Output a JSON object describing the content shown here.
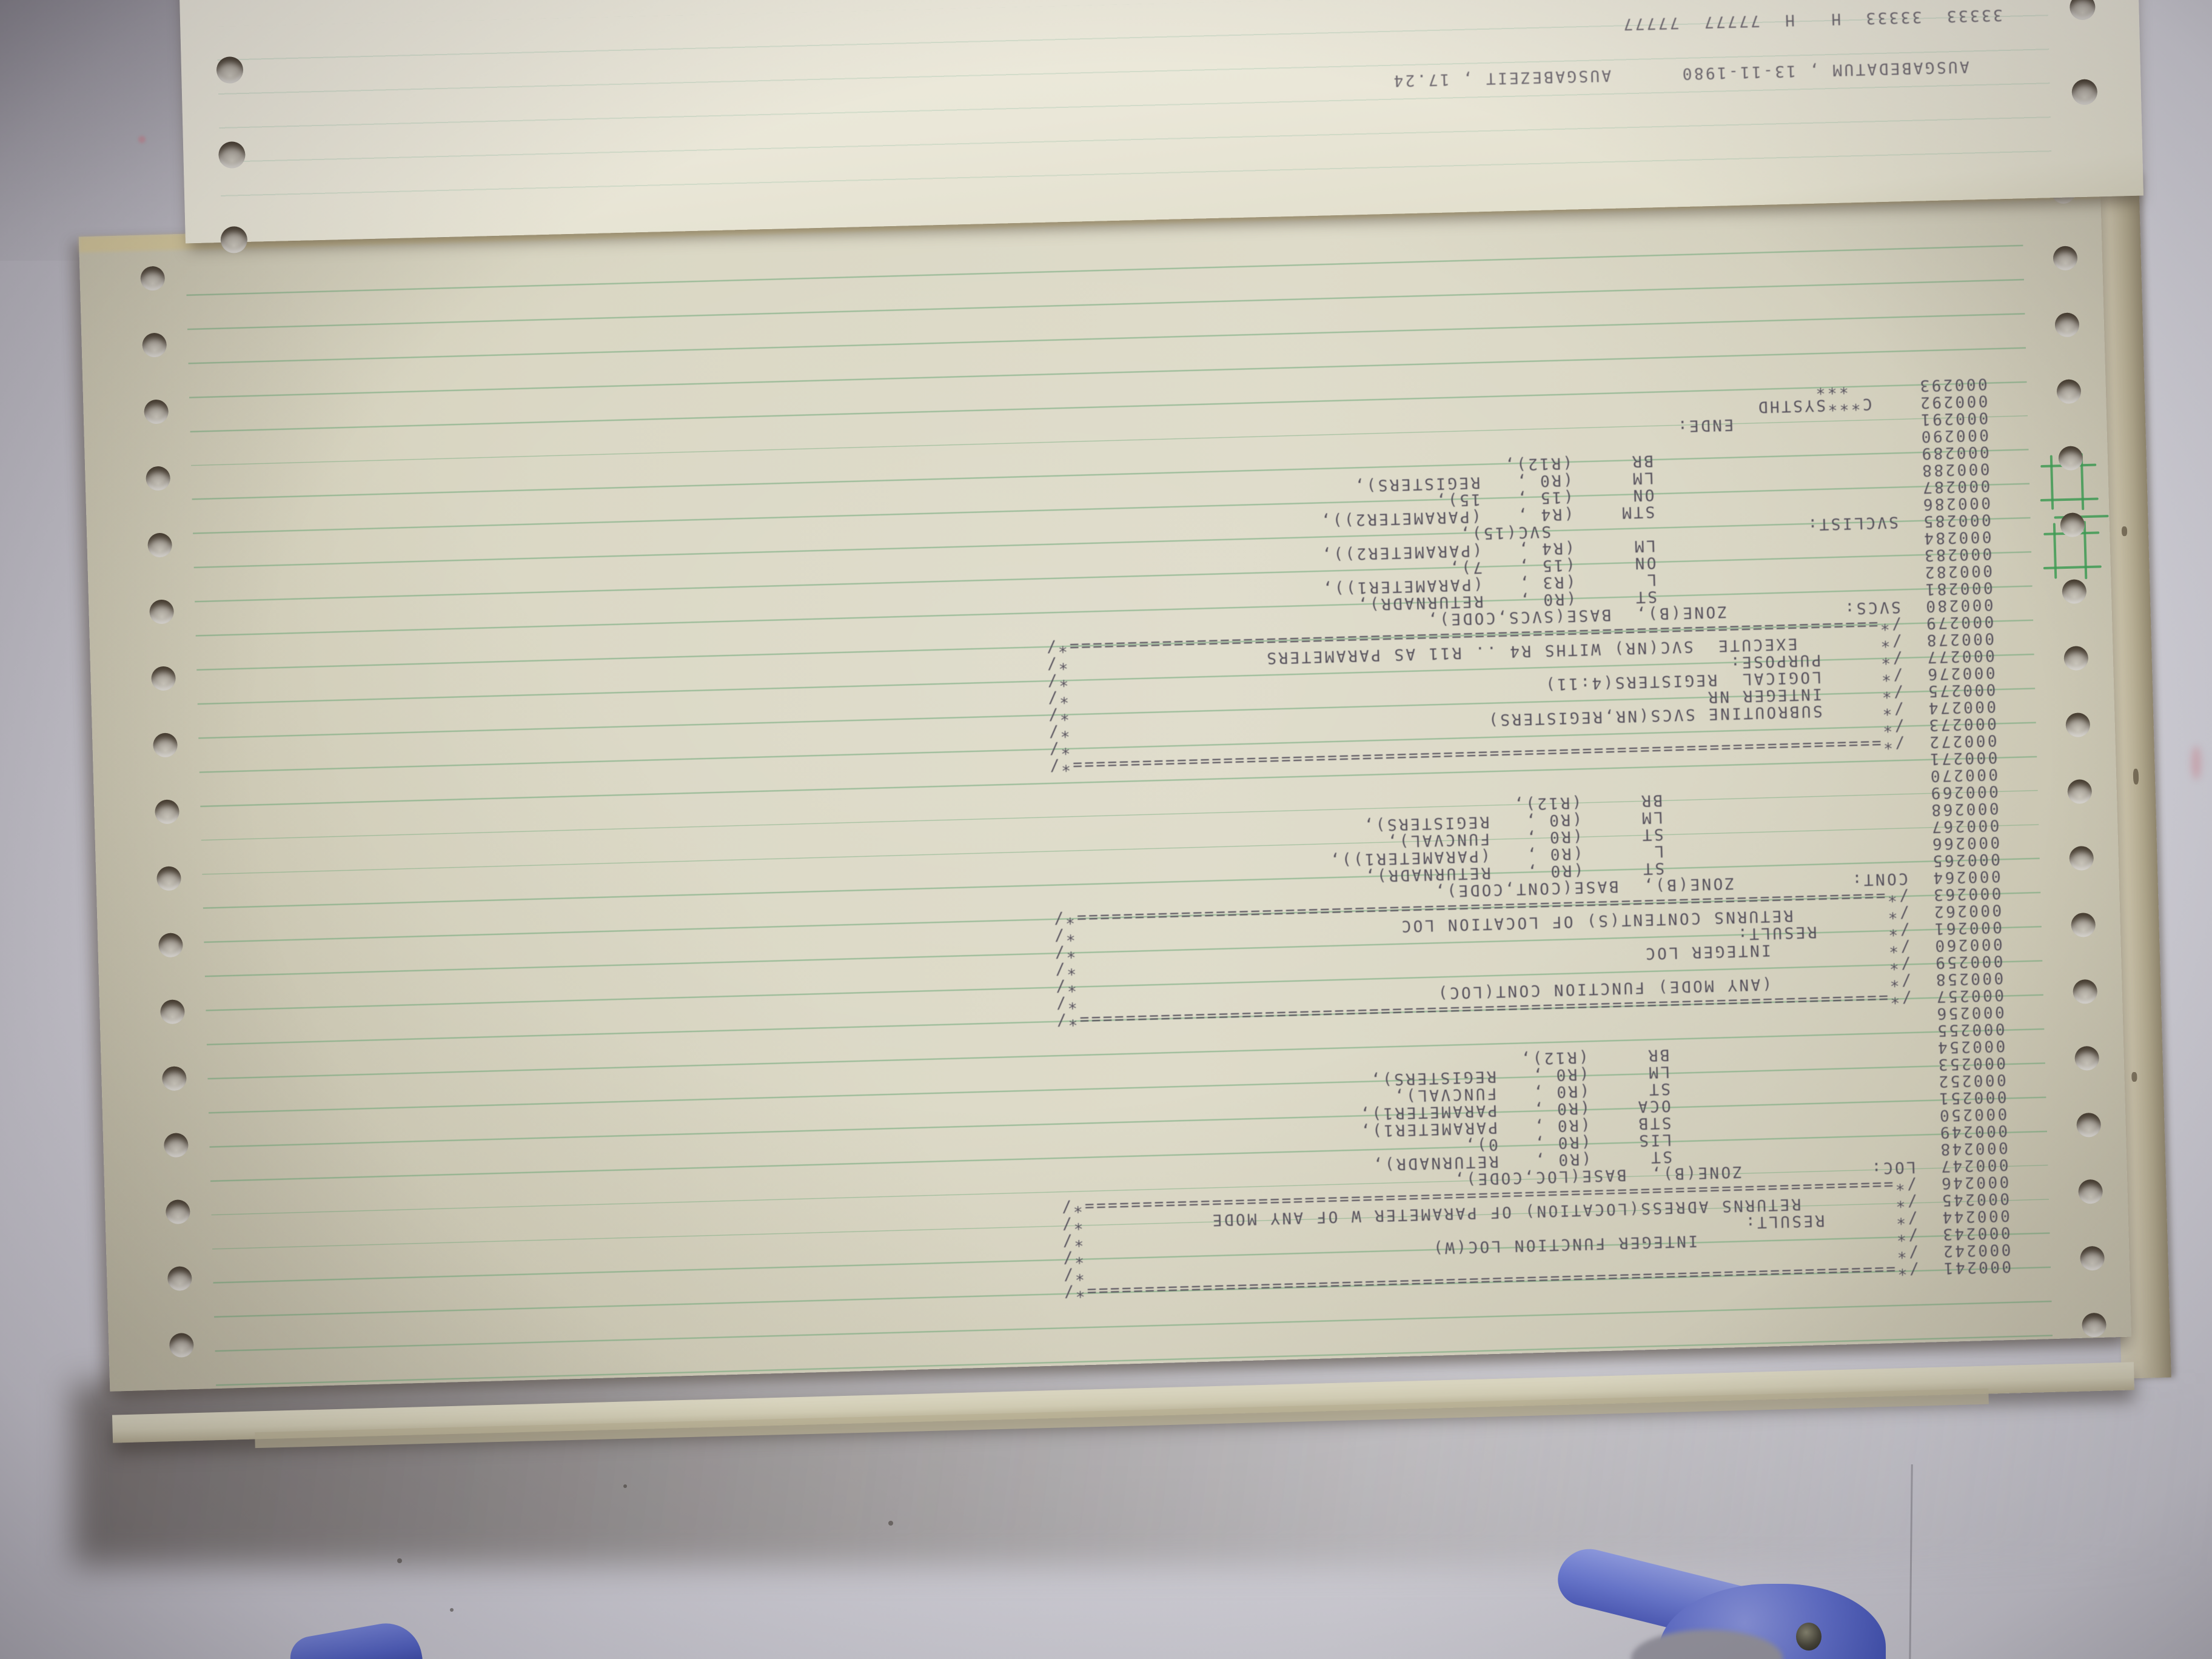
{
  "photo_description": "Photograph of an upside-down fanfold line-printer listing lying on a desk",
  "colors": {
    "desk": "#cccbd3",
    "paper_main": "#dad7c4",
    "paper_back": "#eae7d8",
    "rule_green": "#60a06e",
    "mark_green": "#3f9e55",
    "ink": "#4a4450",
    "stack_tan": "#b1a88c",
    "clamp_blue": "#5e6ed0"
  },
  "back_sheet": {
    "footer_line": "   AUSGABEDATUM , 13-11-1980      AUSGABEZEIT , 17.24",
    "clipped_line": "33333  33333  H   H  77777  77777"
  },
  "listing": {
    "lines": [
      "000241  /*======================================================================*/",
      "000242  /*                                                                      */",
      "000243  /*                 INTEGER FUNCTION LOC(W)                              */",
      "000244  /*      RESULT:                                                         */",
      "000245  /*        RETURNS ADRESS(LOCATION) OF PARAMETER W OF ANY MODE           */",
      "000246  /*======================================================================*/",
      "000247  LOC:           ZONE(B),  BASE(LOC,CODE),",
      "000248                       ST     (R0 ,   RETURNADR),",
      "000249                       LIS    (R0 ,   0),",
      "000250                       STB    (R0 ,   PARAMETER1),",
      "000251                       OCA    (R0 ,   PARAMETER1),",
      "000252                       ST     (R0 ,   FUNCVAL),",
      "000253                       LM     (R0 ,   REGISTERS),",
      "000254                       BR     (R12),",
      "000255",
      "000256",
      "000257  /*======================================================================*/",
      "000258  /*          (ANY MODE) FUNCTION CONT(LOC)                               */",
      "000259  /*                                                                      */",
      "000260  /*          INTEGER LOC                                                 */",
      "000261  /*      RESULT:                                                         */",
      "000262  /*        RETURNS CONTENT(S) OF LOCATION LOC                            */",
      "000263  /*======================================================================*/",
      "000264  CONT:          ZONE(B),  BASE(CONT,CODE),",
      "000265                       ST     (R0 ,   RETURNADR),",
      "000266                       L      (R0 ,   (PARAMETER1)),",
      "000267                       ST     (R0 ,   FUNCVAL),",
      "000268                       LM     (R0 ,   REGISTERS),",
      "000269                       BR     (R12),",
      "000270",
      "000271",
      "000272  /*======================================================================*/",
      "000273  /*                                                                      */",
      "000274  /*     SUBROUTINE SVCS(NR,REGISTERS)                                    */",
      "000275  /*     INTEGER NR                                                       */",
      "000276  /*     LOGICAL  REGISTERS(4:11)                                         */",
      "000277  /*     PURPOSE:                                                         */",
      "000278  /*       EXECUTE  SVC(NR) WITHS R4 .. R11 AS PARAMETERS                 */",
      "000279  /*======================================================================*/",
      "000280  SVCS:          ZONE(B),  BASE(SVCS,CODE),",
      "000281                       ST     (R0 ,   RETURNADR),",
      "000282                       L      (R3 ,   (PARAMETER1)),",
      "000283                       ON     (15 ,   7),",
      "000284                       LM     (R4 ,   (PARAMETER2)),",
      "000285  SVCLIST:                      SVC(15),",
      "000286                       STM    (R4 ,   (PARAMETER2)),",
      "000287                       ON     (15 ,   15),",
      "000288                       LM     (R0 ,   REGISTERS),",
      "000289                       BR     (R12),",
      "000290",
      "000291                ENDE:",
      "000292    C***SYSTHD",
      "000293      ***"
    ]
  }
}
